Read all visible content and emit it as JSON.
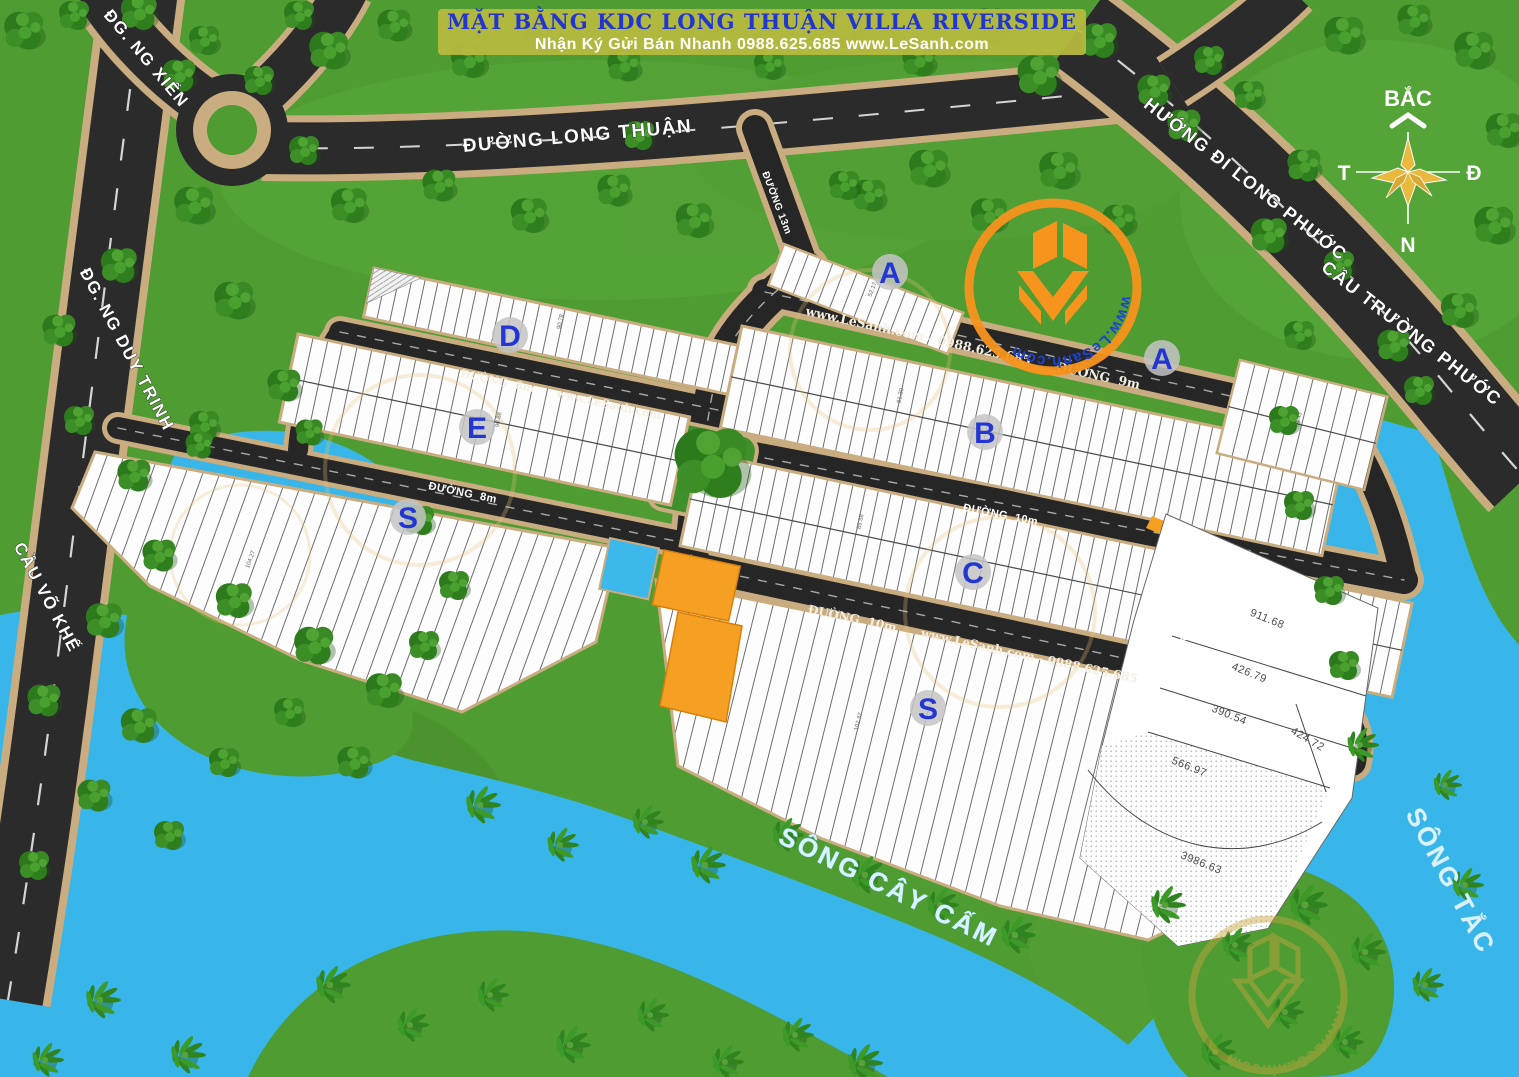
{
  "banner": {
    "title": "MẶT BẰNG KDC LONG THUẬN VILLA RIVERSIDE",
    "subtitle": "Nhận Ký Gửi Bán Nhanh 0988.625.685 www.LeSanh.com"
  },
  "compass": {
    "north": "BẮC",
    "west": "T",
    "east": "Đ",
    "south": "N"
  },
  "roads": {
    "ng_xien": "ĐG. NG XIỂN",
    "long_thuan": "ĐƯỜNG LONG THUẬN",
    "huong_di_long_phuoc": "HƯỚNG ĐI LONG PHƯỚC",
    "cau_truong_phuoc": "CẦU TRƯỜNG PHƯỚC",
    "ng_duy_trinh": "ĐG. NG DUY TRINH",
    "cau_vo_khe": "CẦU VÕ KHẾ"
  },
  "rivers": {
    "cay_cam": "SÔNG CÂY CẤM",
    "tac": "SÔNG TẮC"
  },
  "streets": {
    "d13": "ĐƯỜNG 13m",
    "d9": "www.LeSanh.com - 0988.625.685      ĐƯỜNG  9m",
    "d8a": "ĐƯỜNG  8m      www.LeSanh.com",
    "d8b": "ĐƯỜNG  8m",
    "d10a": "ĐƯỜNG  10m",
    "d10b": "ĐƯỜNG  10m      www.LeSanh.com - 0988.625.685",
    "d10v": "ĐƯỜNG 10m"
  },
  "blocks": {
    "a_top": {
      "label": "A",
      "sample_area": "52.17"
    },
    "a_right": {
      "label": "A",
      "sample_area": "94.43"
    },
    "b": {
      "label": "B",
      "sample_area": "81.30"
    },
    "c": {
      "label": "C",
      "sample_area": "85.58"
    },
    "d": {
      "label": "D",
      "sample_area": "90.78"
    },
    "e": {
      "label": "E",
      "sample_area": "90.88"
    },
    "s_left": {
      "label": "S",
      "sample_area": "104.27"
    },
    "s_bottom": {
      "label": "S",
      "sample_area": "102.37"
    }
  },
  "large_parcels": [
    "911.68",
    "426.79",
    "390.54",
    "424.72",
    "566.97",
    "3986.63"
  ],
  "logo": {
    "url_text": "www.LeSanh.com"
  },
  "colors": {
    "grass": "#4f9c33",
    "water": "#38b6e9",
    "road": "#2b2b2b",
    "sidewalk": "#c9ac7f",
    "banner_bg": "#b9ba3f",
    "title_blue": "#2135d0",
    "block_letter_blue": "#2336d4",
    "accent_orange": "#f7941e",
    "parcel_white": "#fdfdfd"
  }
}
